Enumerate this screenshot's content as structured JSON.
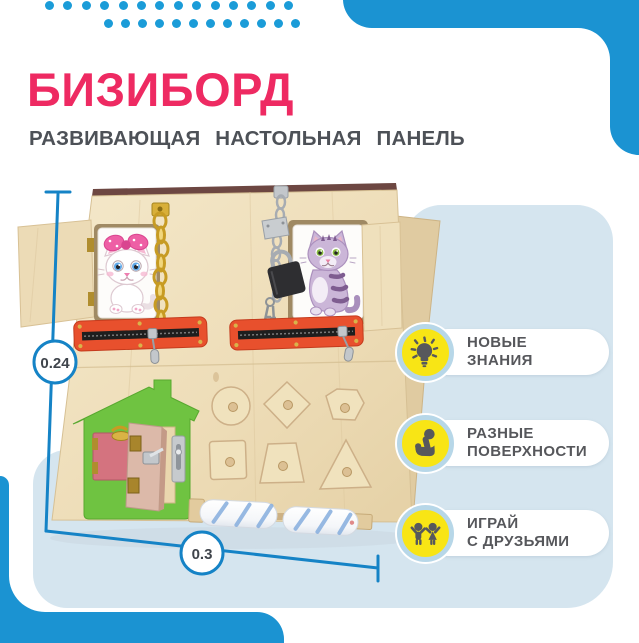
{
  "header": {
    "title": "БИЗИБОРД",
    "subtitle": "РАЗВИВАЮЩАЯ НАСТОЛЬНАЯ ПАНЕЛЬ"
  },
  "colors": {
    "title_pink": "#ee2a62",
    "subtitle_gray": "#4d5157",
    "accent_blue": "#1b9cd8",
    "corner_blue": "#1b93d2",
    "dimension_blue": "#1583c6",
    "panel_light_blue": "#d5e5ef",
    "badge_yellow": "#f8e515",
    "badge_ring_blue": "#b7d7e8",
    "badge_icon_gray": "#57585c",
    "badge_text_gray": "#56575b"
  },
  "decor": {
    "dots_row1_count": 14,
    "dots_row2_count": 12
  },
  "dimensions": {
    "height_label": "0.24",
    "width_label": "0.3"
  },
  "features": [
    {
      "icon": "lightbulb-icon",
      "line1": "НОВЫЕ",
      "line2": "ЗНАНИЯ"
    },
    {
      "icon": "touch-icon",
      "line1": "РАЗНЫЕ",
      "line2": "ПОВЕРХНОСТИ"
    },
    {
      "icon": "friends-icon",
      "line1": "ИГРАЙ",
      "line2": "С ДРУЗЬЯМИ"
    }
  ]
}
